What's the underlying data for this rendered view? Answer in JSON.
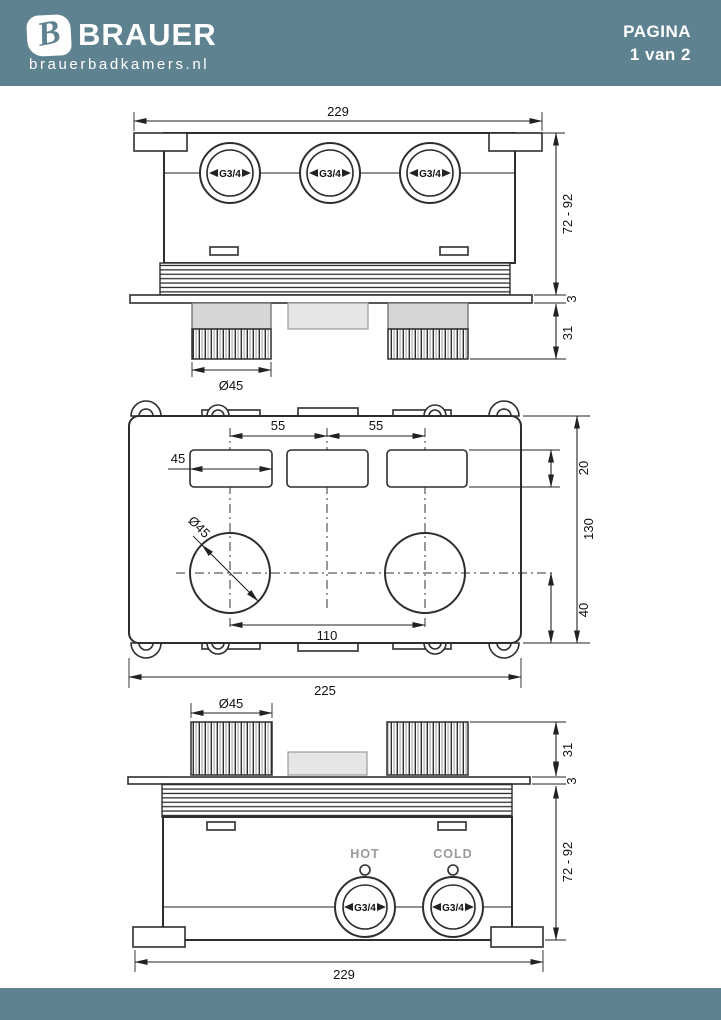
{
  "header": {
    "brand": "BRAUER",
    "brand_domain": "brauerbadkamers.nl",
    "logo_letter": "B",
    "page_label": "PAGINA",
    "page_value": "1 van 2"
  },
  "colors": {
    "band": "#5f8290",
    "line": "#2e2e2e",
    "knob_grey": "#d6d6d6",
    "panel_grey": "#e6e6e6",
    "muted_label": "#9a9a9a"
  },
  "drawings": {
    "back_view": {
      "overall_width": "229",
      "mount_depth_range": "72 - 92",
      "plate_thickness": "3",
      "knob_height": "31",
      "knob_diameter": "Ø45",
      "connection_label": "G3/4"
    },
    "plan_view": {
      "slot_spacing_left": "55",
      "slot_spacing_right": "55",
      "slot_width": "45",
      "slot_height": "20",
      "body_height": "130",
      "center_to_edge": "40",
      "knob_spacing": "110",
      "body_width": "225",
      "hole_diameter": "Ø45"
    },
    "front_view": {
      "knob_diameter": "Ø45",
      "knob_height": "31",
      "plate_thickness": "3",
      "mount_depth_range": "72 - 92",
      "overall_width": "229",
      "hot_label": "HOT",
      "cold_label": "COLD",
      "connection_label": "G3/4"
    }
  }
}
